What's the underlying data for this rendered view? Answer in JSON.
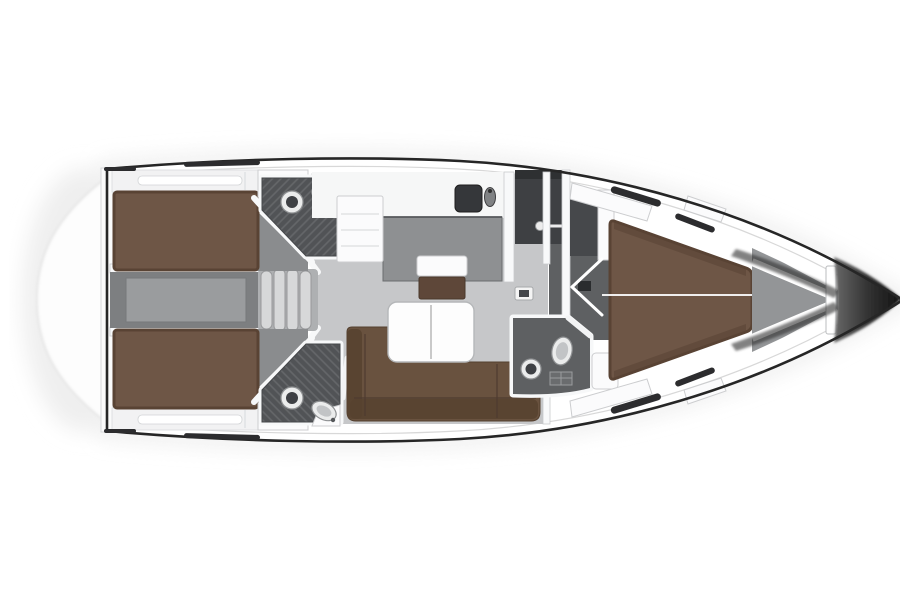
{
  "figure": {
    "type": "sailing-yacht-deck-plan",
    "orientation": "bow-right",
    "visible_text": "none"
  },
  "palette": {
    "hull-white": "#ffffff",
    "wall-white": "#f8f9fa",
    "shadow-tint": "#ebebeb",
    "deck-line": "#262626",
    "berth-brown": "#6e5646",
    "berth-brown-dark": "#594334",
    "sofa-brown": "#69523f",
    "sofa-brown-dark": "#57422f",
    "bench-brown": "#5e4739",
    "floor-light": "#c6c7c9",
    "floor-mid": "#8e9092",
    "floor-dark": "#5e6062",
    "corridor-gray": "#7d7f81",
    "corridor-inner": "#9a9c9e",
    "head-floor": "#515356",
    "head-hatch": "#65676a",
    "shower-dark": "#3e4043",
    "locker-dark": "#46484b",
    "bow-gray": "#939597",
    "bow-grad-start": "#6a6a6a",
    "bow-grad-end": "#121212",
    "table-white": "#fdfdfd",
    "steps-light": "#d7d8d9",
    "fixture-light": "#ebecec",
    "fixture-dark": "#3e4044"
  },
  "rooms": [
    {
      "id": "aft-cabin-port",
      "features": [
        "double-berth"
      ]
    },
    {
      "id": "aft-cabin-starboard",
      "features": [
        "double-berth"
      ]
    },
    {
      "id": "aft-head-port",
      "features": [
        "toilet",
        "sink",
        "door"
      ]
    },
    {
      "id": "aft-head-starboard",
      "features": [
        "toilet",
        "sink",
        "door"
      ]
    },
    {
      "id": "engine-corridor",
      "features": [
        "companionway-steps"
      ]
    },
    {
      "id": "saloon",
      "features": [
        "l-sofa",
        "folding-table",
        "seat-bench"
      ]
    },
    {
      "id": "galley",
      "features": [
        "sink",
        "faucet",
        "cabinet"
      ]
    },
    {
      "id": "shower-room",
      "features": [
        "shower-head"
      ]
    },
    {
      "id": "forward-head",
      "features": [
        "toilet",
        "sink",
        "shower-grate"
      ]
    },
    {
      "id": "forward-cabin",
      "features": [
        "v-berth",
        "side-shelves",
        "door"
      ]
    },
    {
      "id": "anchor-locker",
      "features": [
        "hull-stringers"
      ]
    }
  ],
  "fixtures": {
    "toilets": 3,
    "sinks": 4,
    "shower_heads": 1,
    "companionway_steps": 1,
    "tables": 1,
    "sofas": 1,
    "berths": 3
  }
}
